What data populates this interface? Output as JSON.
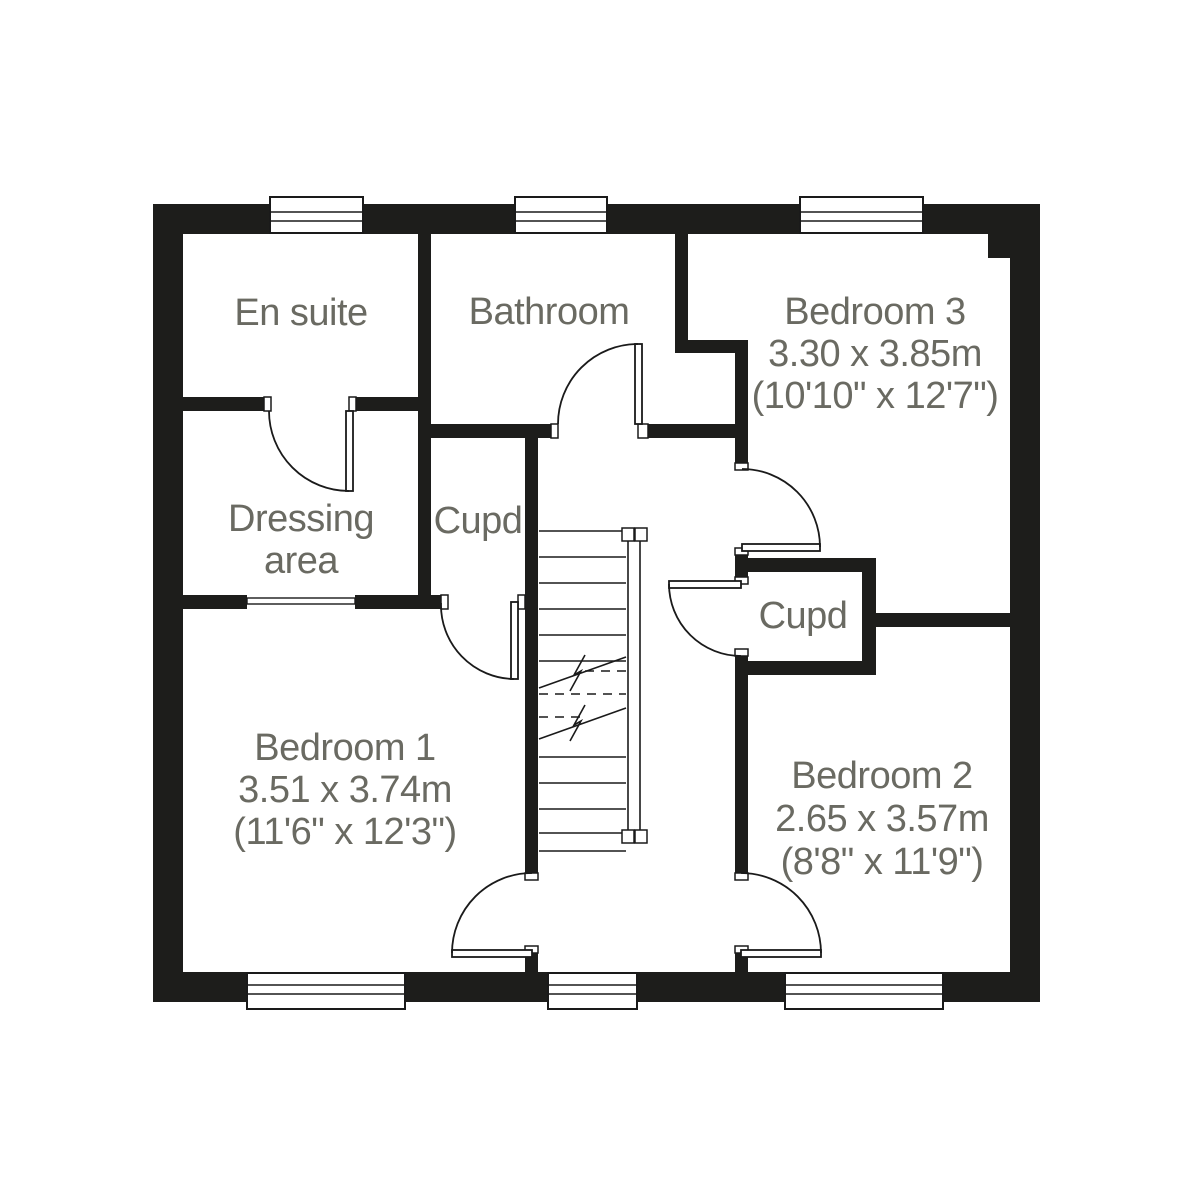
{
  "colors": {
    "wall": "#1d1d1b",
    "line": "#1a1a1a",
    "text": "#6a6a62",
    "background": "#ffffff"
  },
  "rooms": {
    "ensuite": {
      "label": "En suite"
    },
    "bathroom": {
      "label": "Bathroom"
    },
    "bedroom3": {
      "label": "Bedroom 3",
      "metric": "3.30 x 3.85m",
      "imperial": "(10'10\" x 12'7\")"
    },
    "dressing": {
      "label_line1": "Dressing",
      "label_line2": "area"
    },
    "cupboard_left": {
      "label": "Cupd"
    },
    "cupboard_right": {
      "label": "Cupd"
    },
    "bedroom1": {
      "label": "Bedroom 1",
      "metric": "3.51 x 3.74m",
      "imperial": "(11'6\" x 12'3\")"
    },
    "bedroom2": {
      "label": "Bedroom 2",
      "metric": "2.65 x 3.57m",
      "imperial": "(8'8\" x 11'9\")"
    }
  }
}
